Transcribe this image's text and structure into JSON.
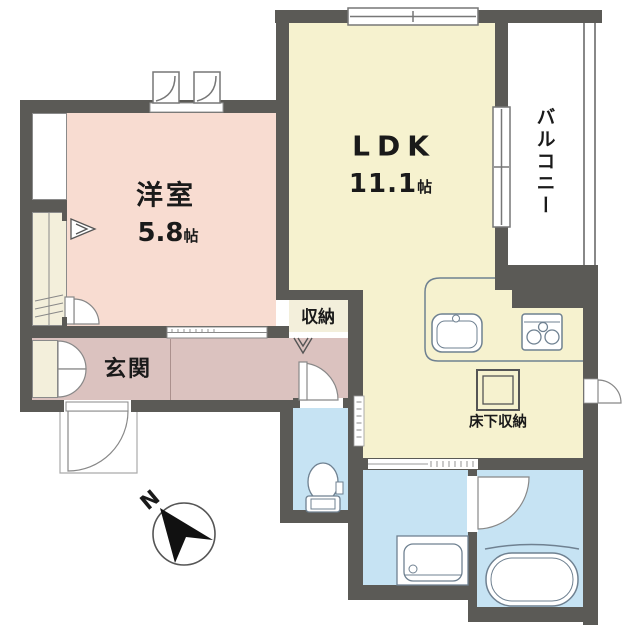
{
  "title": "apartment floor plan",
  "colors": {
    "wall": "#5b5a56",
    "western_room": "#f8dcd1",
    "ldk": "#f6f2cf",
    "entrance": "#dbc2bf",
    "closet": "#f3efdb",
    "wet_area": "#c6e3f3",
    "balcony": "#ffffff",
    "line": "#6f8191",
    "outline": "#555555"
  },
  "rooms": {
    "western_room": {
      "name": "洋室",
      "size_value": "5.8",
      "size_unit": "帖"
    },
    "ldk": {
      "name": "LDK",
      "size_value": "11.1",
      "size_unit": "帖"
    },
    "balcony": {
      "name": "バルコニー"
    },
    "storage": {
      "name": "収納"
    },
    "entrance": {
      "name": "玄関"
    },
    "floor_storage": {
      "name": "床下収納"
    }
  },
  "compass": {
    "north_label": "N"
  },
  "fixtures": {
    "kitchen_sink": "kitchen-sink",
    "stove": "gas-stove",
    "toilet": "toilet",
    "bathtub": "bathtub",
    "washbasin": "washbasin-vanity",
    "north_arrow": "north-arrow-compass"
  }
}
